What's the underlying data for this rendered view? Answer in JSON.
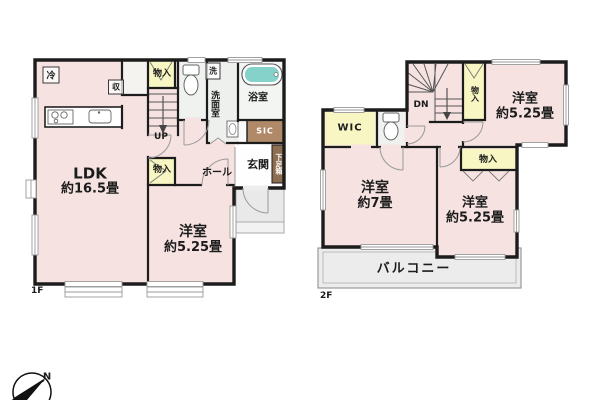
{
  "floor1": {
    "floor_label": "1F",
    "ldk": {
      "name": "LDK",
      "size": "約16.5畳"
    },
    "bedroom": {
      "name": "洋室",
      "size": "約5.25畳"
    },
    "hall": "ホール",
    "entrance": "玄関",
    "shoe_cabinet": "下足箱",
    "sic": "SIC",
    "bathroom": "浴室",
    "washroom": "洗面室",
    "washer_symbol": "洗",
    "refrigerator_symbol": "冷",
    "closet_upper": "物入",
    "closet_lower": "物入",
    "storage_symbol": "収",
    "stairs_label": "UP"
  },
  "floor2": {
    "floor_label": "2F",
    "stairs_label": "DN",
    "closet_by_stairs": "物入",
    "bedroom_ne": {
      "name": "洋室",
      "size": "約5.25畳"
    },
    "wic": "WIC",
    "bedroom_west": {
      "name": "洋室",
      "size": "約7畳"
    },
    "closet_south": "物入",
    "bedroom_se": {
      "name": "洋室",
      "size": "約5.25畳"
    },
    "balcony": "バルコニー"
  },
  "compass": {
    "north": "N"
  },
  "colors": {
    "wall": "#1c1c1c",
    "room_fill": "#f6e3e1",
    "closet_fill": "#f8f6c2",
    "sic_fill": "#b08a68",
    "shoe_cabinet_fill": "#8d6e50",
    "bathtub_fill": "#85d2ca",
    "wet_area_fill": "#eef1ee",
    "outdoor_fill": "#ebebeb"
  }
}
